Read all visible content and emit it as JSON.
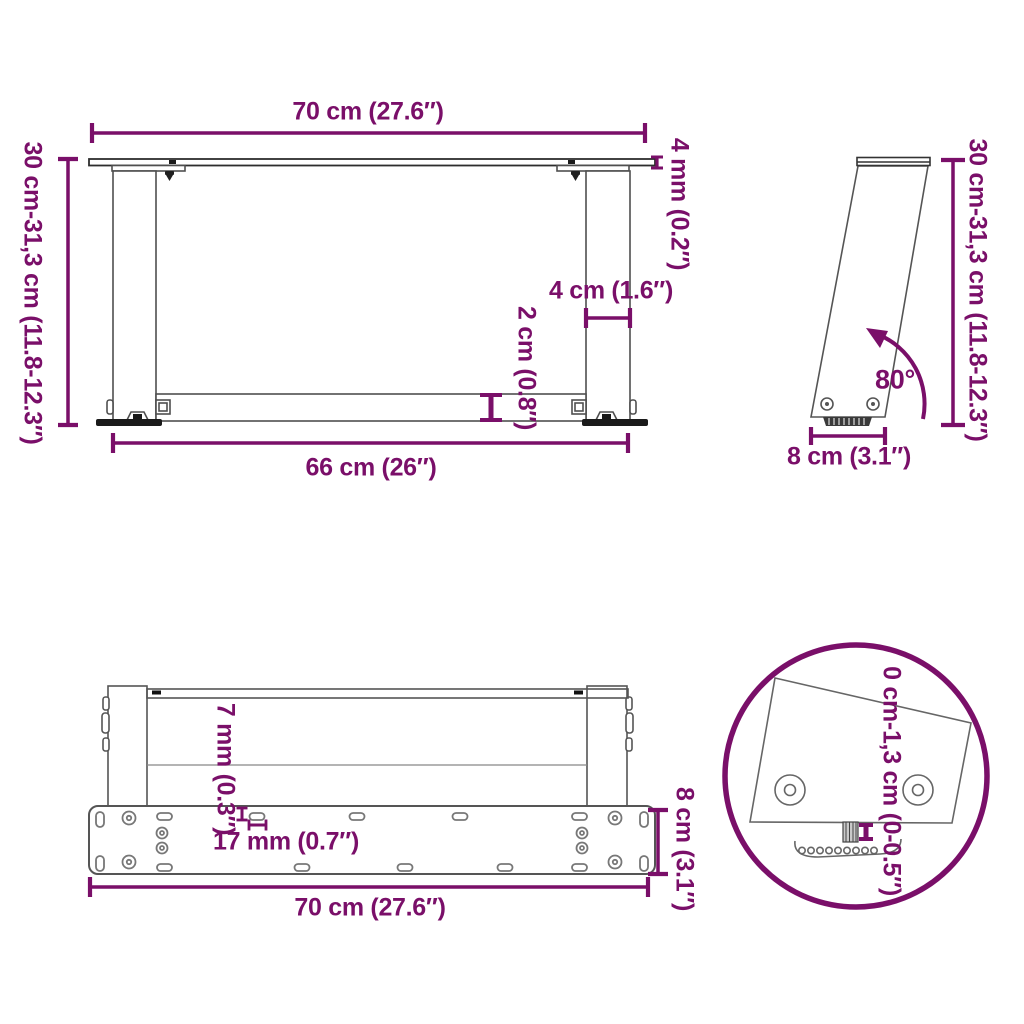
{
  "colors": {
    "accent": "#7a0f69",
    "line": "#4f4f4f",
    "dark": "#1a1a1a"
  },
  "labels": {
    "top_width": "70 cm (27.6″)",
    "height_left": "30 cm-31,3 cm (11.8-12.3″)",
    "top_thickness": "4 mm (0.2″)",
    "leg_width": "4 cm (1.6″)",
    "bar_thickness": "2 cm (0.8″)",
    "inner_width": "66 cm (26″)",
    "angle": "80°",
    "height_right": "30 cm-31,3 cm (11.8-12.3″)",
    "side_depth": "8 cm (3.1″)",
    "slot_width": "7 mm (0.3″)",
    "slot_length": "17 mm (0.7″)",
    "plate_depth": "8 cm (3.1″)",
    "bottom_width": "70 cm (27.6″)",
    "adjust_range": "0 cm-1,3 cm (0-0.5″)"
  }
}
